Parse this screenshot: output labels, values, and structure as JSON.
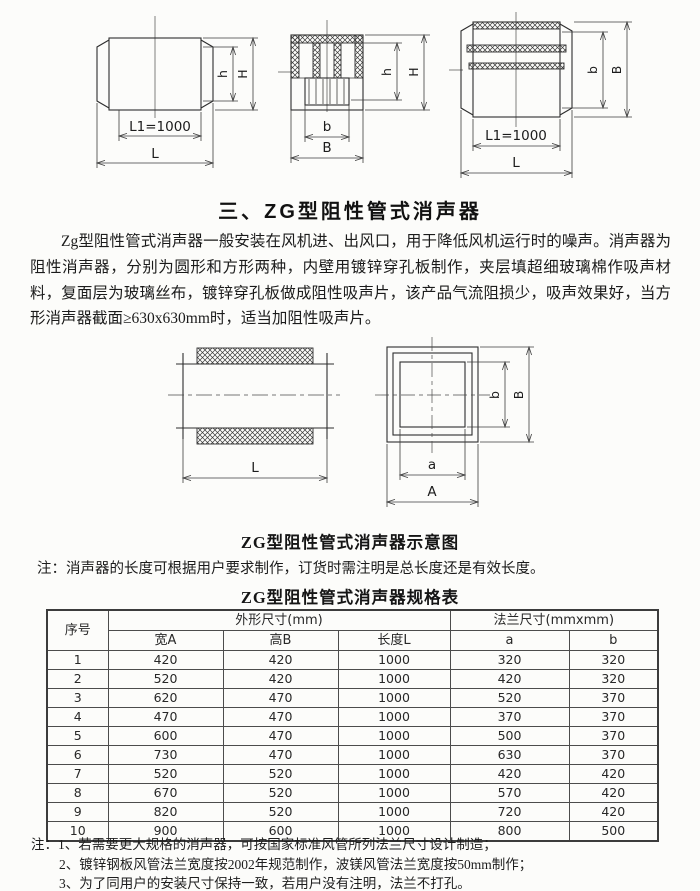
{
  "document": {
    "section_title": "三、ZG型阻性管式消声器",
    "intro_paragraph": "Zg型阻性管式消声器一般安装在风机进、出风口，用于降低风机运行时的噪声。消声器为阻性消声器，分别为圆形和方形两种，内壁用镀锌穿孔板制作，夹层填超细玻璃棉作吸声材料，复面层为玻璃丝布，镀锌穿孔板做成阻性吸声片，该产品气流阻损少，吸声效果好，当方形消声器截面≥630x630mm时，适当加阻性吸声片。",
    "diagram_caption": "ZG型阻性管式消声器示意图",
    "diagram_note": "注：消声器的长度可根据用户要求制作，订货时需注明是总长度还是有效长度。",
    "table_title": "ZG型阻性管式消声器规格表"
  },
  "drawing_labels": {
    "l1_1000": "L1=1000",
    "length_l": "L",
    "b_small": "b",
    "b_big": "B",
    "h_small": "h",
    "h_big": "H",
    "a_small": "a",
    "a_big": "A"
  },
  "spec_table": {
    "columns": {
      "index": "序号",
      "outline_group": "外形尺寸(mm)",
      "flange_group": "法兰尺寸(mmxmm)",
      "width_a": "宽A",
      "height_b": "高B",
      "length_l": "长度L",
      "flange_a": "a",
      "flange_b": "b"
    },
    "rows": [
      {
        "no": "1",
        "wa": "420",
        "hb": "420",
        "l": "1000",
        "fa": "320",
        "fb": "320"
      },
      {
        "no": "2",
        "wa": "520",
        "hb": "420",
        "l": "1000",
        "fa": "420",
        "fb": "320"
      },
      {
        "no": "3",
        "wa": "620",
        "hb": "470",
        "l": "1000",
        "fa": "520",
        "fb": "370"
      },
      {
        "no": "4",
        "wa": "470",
        "hb": "470",
        "l": "1000",
        "fa": "370",
        "fb": "370"
      },
      {
        "no": "5",
        "wa": "600",
        "hb": "470",
        "l": "1000",
        "fa": "500",
        "fb": "370"
      },
      {
        "no": "6",
        "wa": "730",
        "hb": "470",
        "l": "1000",
        "fa": "630",
        "fb": "370"
      },
      {
        "no": "7",
        "wa": "520",
        "hb": "520",
        "l": "1000",
        "fa": "420",
        "fb": "420"
      },
      {
        "no": "8",
        "wa": "670",
        "hb": "520",
        "l": "1000",
        "fa": "570",
        "fb": "420"
      },
      {
        "no": "9",
        "wa": "820",
        "hb": "520",
        "l": "1000",
        "fa": "720",
        "fb": "420"
      },
      {
        "no": "10",
        "wa": "900",
        "hb": "600",
        "l": "1000",
        "fa": "800",
        "fb": "500"
      }
    ]
  },
  "footnotes": {
    "line1": "注：1、若需要更大规格的消声器，可按国家标准风管所列法兰尺寸设计制造；",
    "line2": "2、镀锌钢板风管法兰宽度按2002年规范制作，波镁风管法兰宽度按50mm制作；",
    "line3": "3、为了同用户的安装尺寸保持一致，若用户没有注明，法兰不打孔。"
  }
}
